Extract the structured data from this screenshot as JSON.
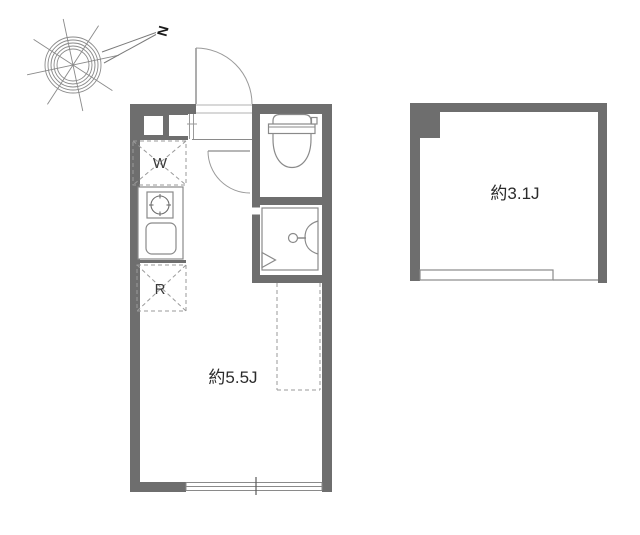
{
  "compass": {
    "north_label": "N"
  },
  "rooms": {
    "main": {
      "area_label": "約5.5J"
    },
    "side": {
      "area_label": "約3.1J"
    }
  },
  "fixtures": {
    "washer_label": "W",
    "fridge_label": "R"
  },
  "colors": {
    "wall": "#6e6e6e",
    "outline": "#8a8a8a",
    "dashed": "#9a9a9a",
    "text": "#2b2b2b",
    "background": "#ffffff"
  }
}
